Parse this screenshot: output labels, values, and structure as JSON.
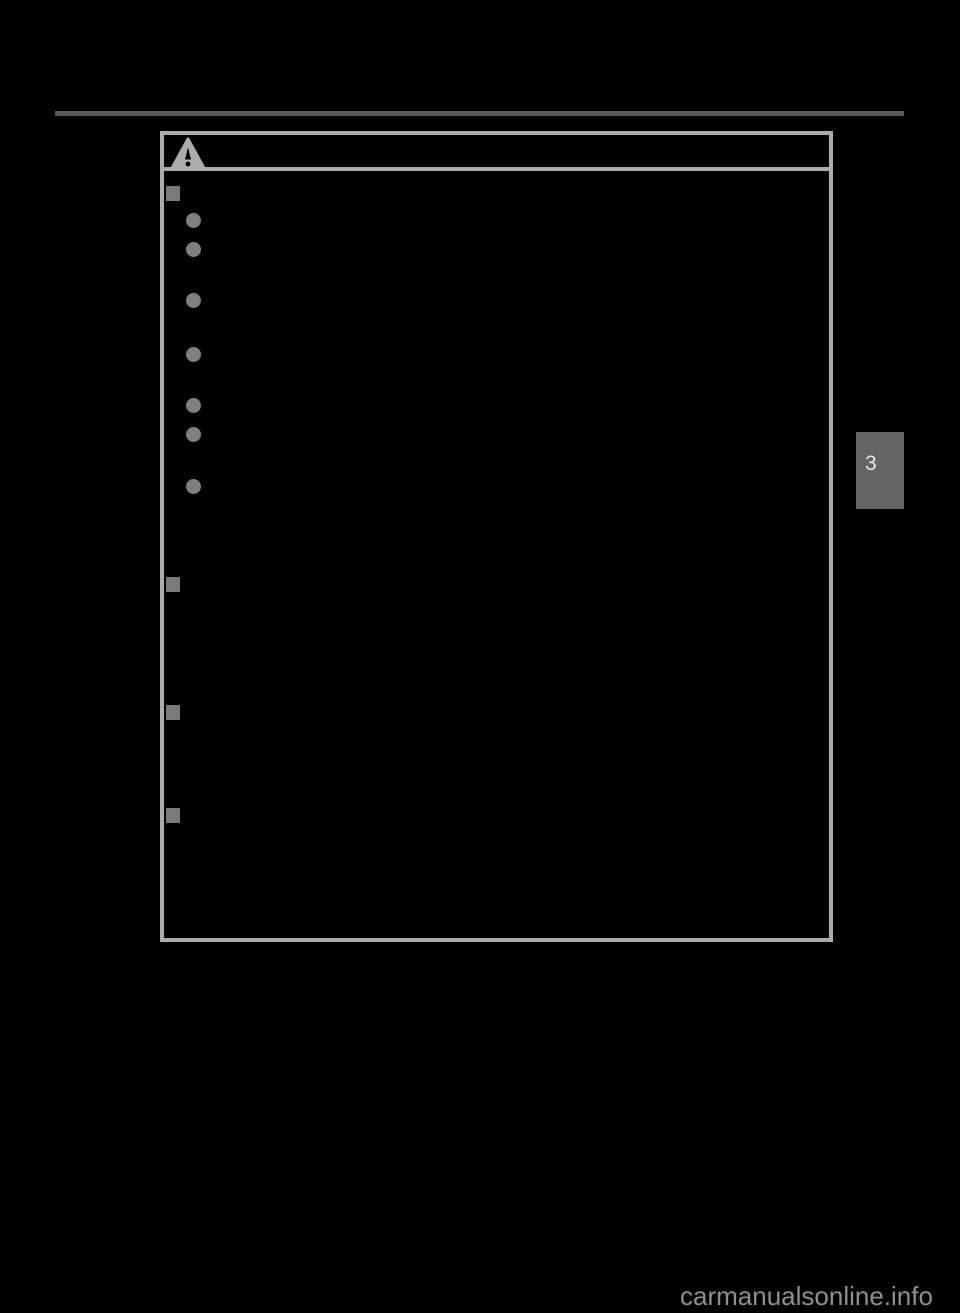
{
  "page": {
    "background_color": "#000000",
    "watermark_text": "carmanualsonline.info",
    "chapter_tab_number": "3"
  },
  "colors": {
    "top_rule": "#595959",
    "box_border": "#acacac",
    "warning_triangle_fill": "#acacac",
    "warning_triangle_exclamation": "#000000",
    "bullet_circle": "#7f7f7f",
    "bullet_square": "#7a7a7a",
    "chapter_tab_bg": "#646464",
    "chapter_tab_text": "#e8e8e8",
    "watermark": "#8f8f8f"
  },
  "warning_box": {
    "icon": "warning-triangle-icon",
    "section_markers": [
      {
        "top": 186
      },
      {
        "top": 577
      },
      {
        "top": 705
      },
      {
        "top": 808
      }
    ],
    "item_markers": [
      {
        "top": 213
      },
      {
        "top": 242
      },
      {
        "top": 293
      },
      {
        "top": 347
      },
      {
        "top": 398
      },
      {
        "top": 427
      },
      {
        "top": 479
      }
    ]
  }
}
